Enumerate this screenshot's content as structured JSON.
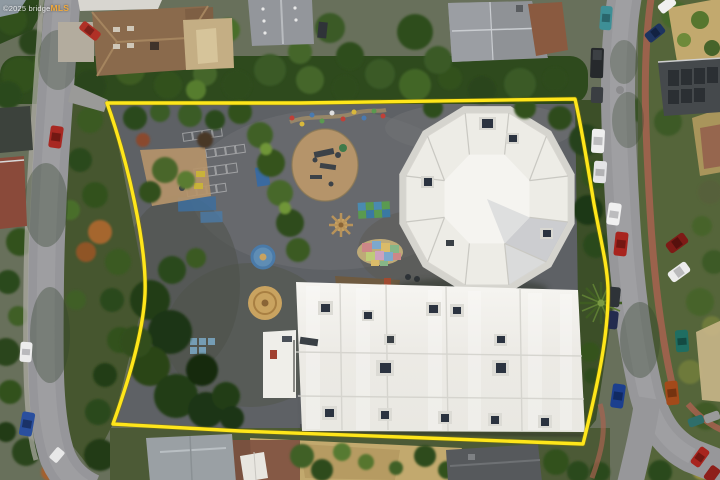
{
  "watermark": {
    "prefix": "©2025 bridge",
    "brand": "MLS"
  },
  "colors": {
    "boundary": "#FFE61A",
    "watermark_text": "#FFFFFF",
    "watermark_brand": "#F2A93A"
  },
  "scene": {
    "type": "aerial-drone-photo",
    "subject": "school campus parcel outlined in yellow",
    "features": [
      "octagonal white-roofed building",
      "large white flat-roof building with rooftop HVAC units",
      "asphalt playground with painted game markings (blue courts, circles, sun, checkerboard, US map mural)",
      "play structures on tan safety surfacing",
      "yellow property boundary line",
      "residential streets with parked cars on both sides",
      "surrounding houses and mature trees, one palm tree"
    ]
  }
}
